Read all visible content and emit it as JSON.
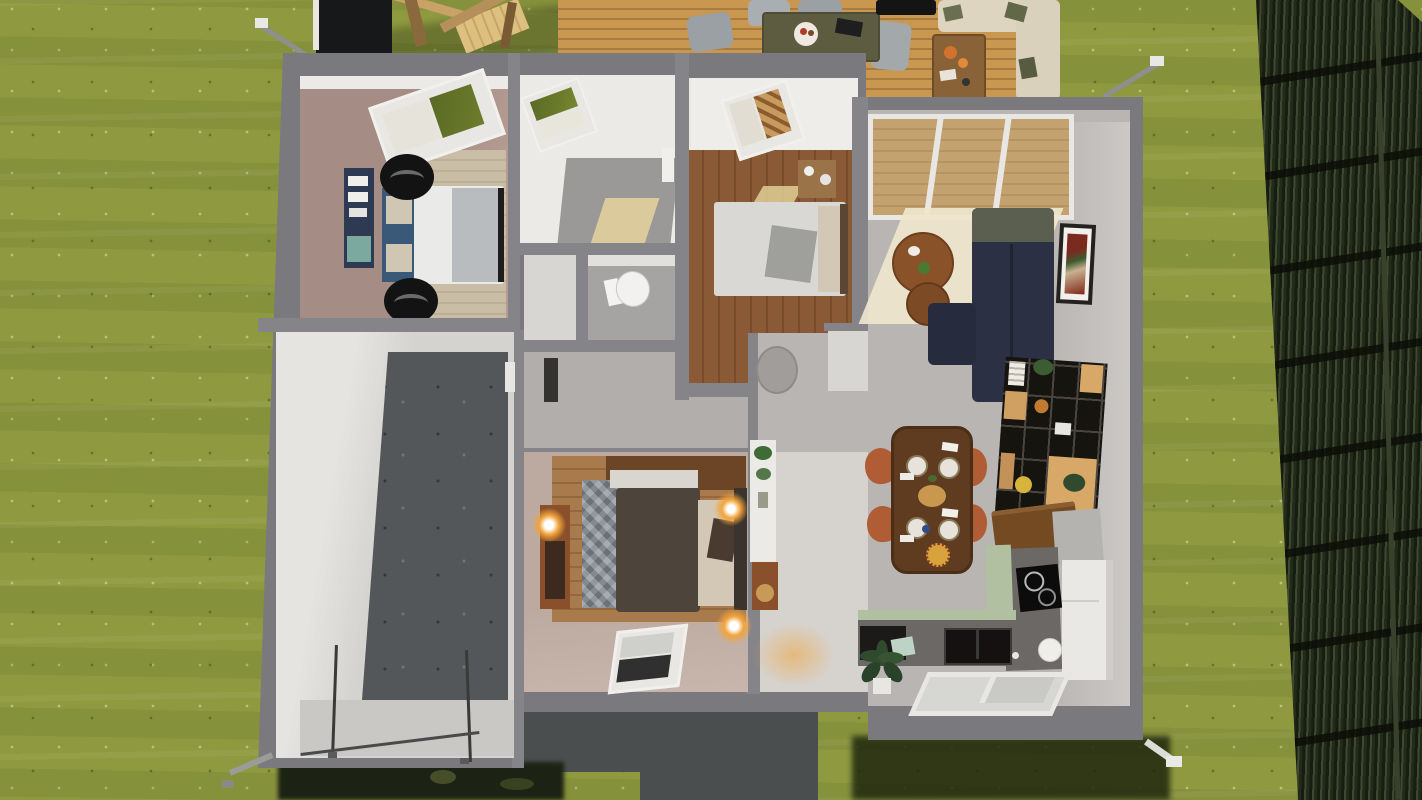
{
  "scene": {
    "type": "3d-home-floorplan-render",
    "view": "top-down cutaway of a single-storey house interior on a lawn",
    "rooms": [
      {
        "name": "bedroom-master",
        "floor": "taupe",
        "furniture": [
          "double-bed-white-duvet",
          "blue-pillows",
          "navy-headboard-shelf",
          "two-black-round-chairs",
          "beige-rug",
          "roof-window"
        ]
      },
      {
        "name": "bathroom",
        "floor": "white",
        "furniture": [
          "gray-tile-shower-area",
          "roof-window",
          "sunlight-patch"
        ]
      },
      {
        "name": "wc",
        "floor": "gray",
        "furniture": [
          "toilet"
        ]
      },
      {
        "name": "closet-corridor",
        "floor": "gray",
        "furniture": [
          "dark-doorway-niche"
        ]
      },
      {
        "name": "bedroom-guest",
        "floor": "wood-planks",
        "furniture": [
          "bed-light-gray",
          "cream-pillows",
          "dresser",
          "roof-window",
          "sunlight-patch"
        ]
      },
      {
        "name": "bedroom-dark",
        "floor": "wood-planks-taupe-border",
        "furniture": [
          "dark-bed",
          "zigzag-gray-blanket",
          "cream-pillows",
          "wardrobe",
          "three-glowing-wall-lamps",
          "roof-window-dark"
        ]
      },
      {
        "name": "entry-hall",
        "floor": "light-gray",
        "furniture": [
          "round-side-table",
          "white-sideboard-with-plants",
          "bar-cart",
          "lamp-glow"
        ]
      },
      {
        "name": "living-dining-kitchen",
        "floor": "light-gray",
        "furniture": [
          "glass-conservatory-roof",
          "navy-l-sofa",
          "round-nesting-tables",
          "wall-picture",
          "black-shelving-unit",
          "bar-counter",
          "dining-table-with-food",
          "four-orange-chairs",
          "l-shaped-kitchen",
          "induction-cooktop",
          "black-sink",
          "fridge",
          "potted-plant",
          "roof-window"
        ]
      },
      {
        "name": "garage",
        "floor": "concrete",
        "furniture": [
          "garage-door-rails"
        ]
      }
    ],
    "exterior": [
      "lawn",
      "dark-slatted-fence",
      "wooden-deck-terrace",
      "outdoor-dining-table",
      "gray-deck-chairs",
      "black-grill",
      "cream-outdoor-sofa",
      "coffee-table",
      "black-shed",
      "wooden-play-structure",
      "rain-gutters-downpipes",
      "concrete-path",
      "shadow-areas"
    ]
  },
  "palette": {
    "grass": "#8f9a40",
    "wall": "#7a797d",
    "wallIn": "#858489",
    "white": "#eceae6",
    "whiteDim": "#d8d6d2",
    "deck": "#c9974f",
    "deckLine": "#a87c3e",
    "taupe": "#a58d85",
    "taupe2": "#bcaaa0",
    "wood": "#8a5a36",
    "woodLine": "#774b2b",
    "wood2": "#a97a4c",
    "wood2Line": "#93683f",
    "woodTop": "#6b4526",
    "grayFloor": "#b9b5b2",
    "grayFloor2": "#a6a4a2",
    "corridor": "#b1aeab",
    "hallFloor": "#d6d3cf",
    "concrete": "#54575a",
    "concreteLt": "#cac8c4",
    "pathDark": "#4b4e4f",
    "shadowDark": "#20270f",
    "patchDark": "#1c2214",
    "fence1": "#171c10",
    "fence2": "#3e4730",
    "fence3": "#232a18",
    "navy": "#2b3044",
    "navyDk": "#262b3d",
    "olive": "#5a5f50",
    "creamSofa": "#ddd5c0",
    "orangeChair": "#b05c35",
    "tableWood": "#5f3c1f",
    "shelfBk": "#16140f",
    "boxWood": "#d8a868",
    "kGreen": "#b2c0a2",
    "counter": "#6b6865",
    "black": "#141414",
    "bedWhite": "#eaeae8",
    "blanketGy": "#b9bcbe",
    "pillowBlue": "#3a5878",
    "bed3": "#4d443c",
    "cream2": "#d3c8b6",
    "glow": "#f2a43c",
    "skyGreen": "#5a6a24",
    "glassDk": "#303030",
    "frame": "#e9e7e3",
    "rug": "#c9bda5",
    "brown": "#8a5229",
    "brown2": "#8a4f2b",
    "tileGray": "#9b9997",
    "sun": "#e6d49c",
    "sunBig": "#efe6cd",
    "grillGray": "#9aa0a3",
    "oliveTbl": "#5d5b40",
    "fridge": "#e9e8e4",
    "barTop": "#734a22",
    "shed": "#17181a",
    "play": "#c8a266"
  }
}
